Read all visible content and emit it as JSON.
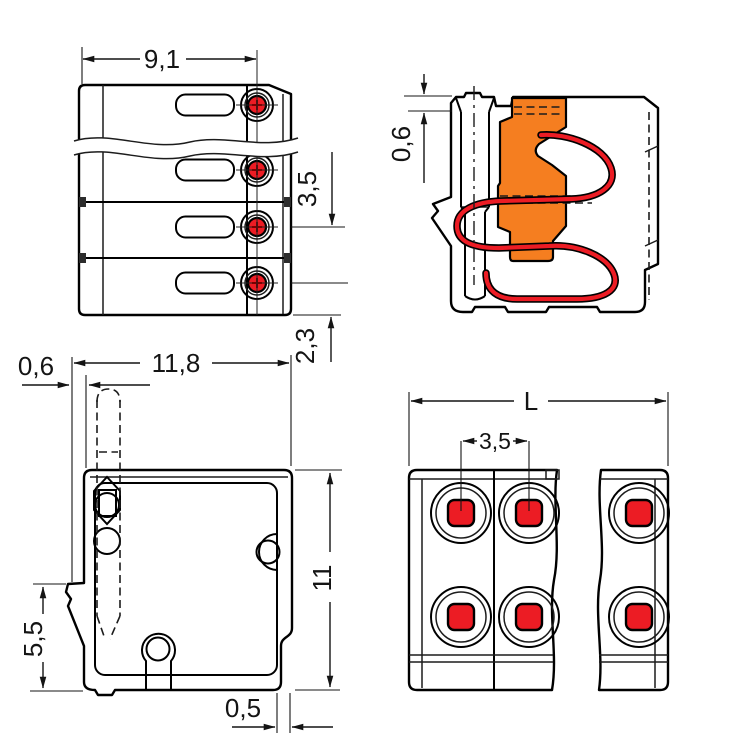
{
  "drawing": {
    "type": "technical-dimension-drawing",
    "colors": {
      "body_gray": "#c9c9c9",
      "clamp_orange": "#f57e20",
      "contact_red": "#ec1c24",
      "line": "#141414",
      "background": "#ffffff"
    },
    "views": {
      "front": {
        "dims": {
          "width": "9,1",
          "pole_pitch": "3,5",
          "pin_offset": "2,3"
        }
      },
      "section": {
        "dims": {
          "rim_height": "0,6"
        }
      },
      "side": {
        "dims": {
          "latch_depth": "0,6",
          "depth": "11,8",
          "height": "11",
          "latch_height": "5,5",
          "edge_inset": "0,5"
        }
      },
      "top": {
        "dims": {
          "length": "L",
          "pole_pitch": "3,5"
        }
      }
    }
  }
}
